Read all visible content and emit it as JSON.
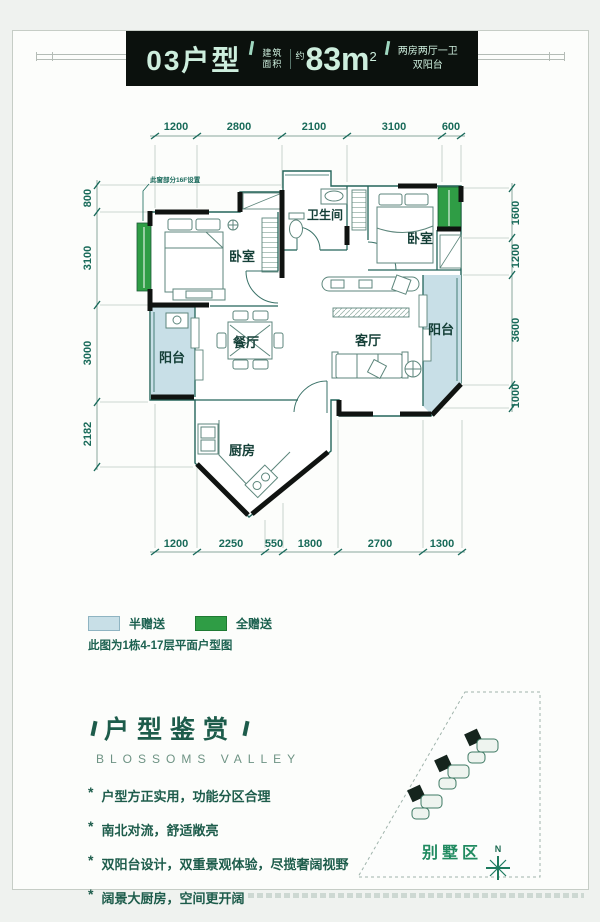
{
  "header": {
    "unit": "03户型",
    "area_label_top": "建筑",
    "area_label_bottom": "面积",
    "approx": "约",
    "area_value": "83m",
    "area_sup": "2",
    "desc_line1": "两房两厅一卫",
    "desc_line2": "双阳台"
  },
  "plan": {
    "note": "此窗部分16F设置",
    "rooms": {
      "bedroom_left": "卧室",
      "bathroom": "卫生间",
      "bedroom_right": "卧室",
      "dining": "餐厅",
      "living": "客厅",
      "balcony_left": "阳台",
      "balcony_right": "阳台",
      "kitchen": "厨房"
    },
    "dims": {
      "top": [
        "1200",
        "2800",
        "2100",
        "3100",
        "600"
      ],
      "bottom": [
        "1200",
        "2250",
        "550",
        "1800",
        "2700",
        "1300"
      ],
      "left": [
        "800",
        "3100",
        "3000",
        "2182"
      ],
      "right": [
        "1600",
        "1200",
        "3600",
        "1000"
      ]
    }
  },
  "legend": {
    "half": "半赠送",
    "full": "全赠送",
    "half_color": "#c8dfe7",
    "full_color": "#2f9d45",
    "note": "此图为1栋4-17层平面户型图"
  },
  "appreciation": {
    "title": "户型鉴赏",
    "subtitle": "BLOSSOMS VALLEY",
    "bullet_char": "*",
    "bullets": [
      "户型方正实用，功能分区合理",
      "南北对流，舒适敞亮",
      "双阳台设计，双重景观体验，尽揽奢阔视野",
      "阔景大厨房，空间更开阔"
    ]
  },
  "site": {
    "label": "别墅区",
    "compass": "N"
  },
  "colors": {
    "banner_bg": "#0b110d",
    "banner_text": "#cdeedd",
    "accent_green": "#1d5c4b",
    "dim_text": "#186a59"
  }
}
